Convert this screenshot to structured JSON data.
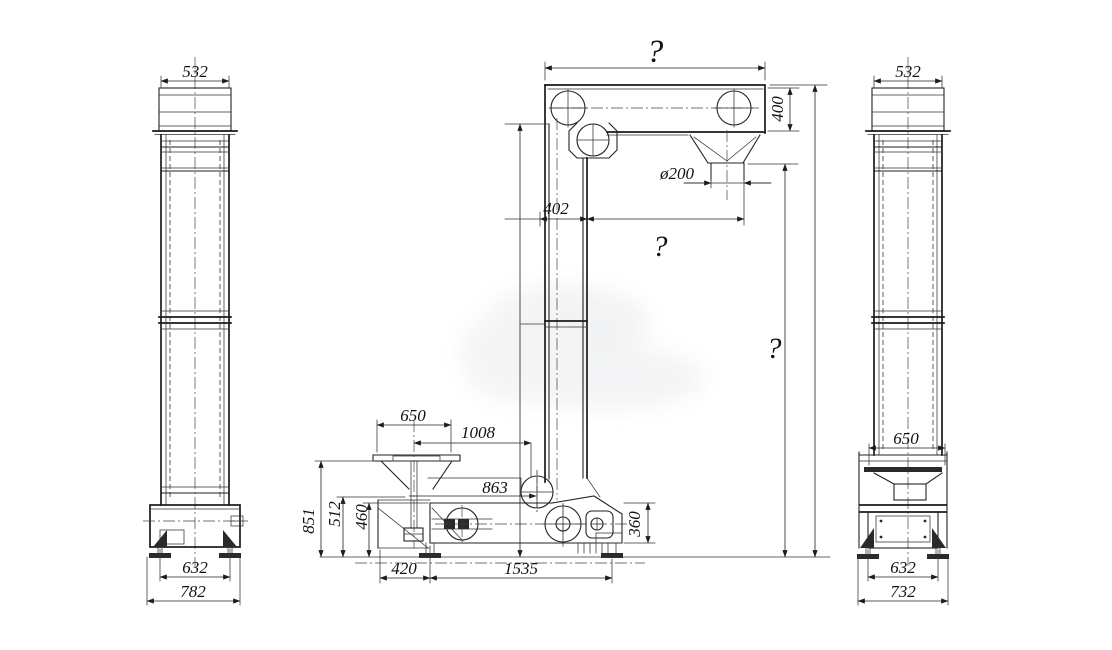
{
  "drawing": {
    "type": "technical-drawing",
    "subject": "bucket elevator three-view dimensioned drawing",
    "colors": {
      "background": "#ffffff",
      "line": "#1c1c1c",
      "text": "#111111"
    }
  },
  "views": {
    "left": {
      "label": "left side view",
      "dims": {
        "top_width": "532",
        "foot_spacing": "632",
        "base_width": "782"
      }
    },
    "front": {
      "label": "front view",
      "dims": {
        "head_length": "?",
        "head_height": "400",
        "spout_diameter": "ø200",
        "leg_width": "402",
        "leg_to_spout": "?",
        "discharge_height": "?",
        "hopper_width": "650",
        "hopper_to_leg": "1008",
        "feed_plate": "863",
        "hopper_top_height": "851",
        "outlet_height": "512",
        "frame_height": "460",
        "hopper_overhang": "420",
        "boot_length": "1535",
        "boot_end_height": "360"
      }
    },
    "right": {
      "label": "right side view",
      "dims": {
        "top_width": "532",
        "hopper_width": "650",
        "foot_spacing": "632",
        "base_width": "732"
      }
    }
  }
}
